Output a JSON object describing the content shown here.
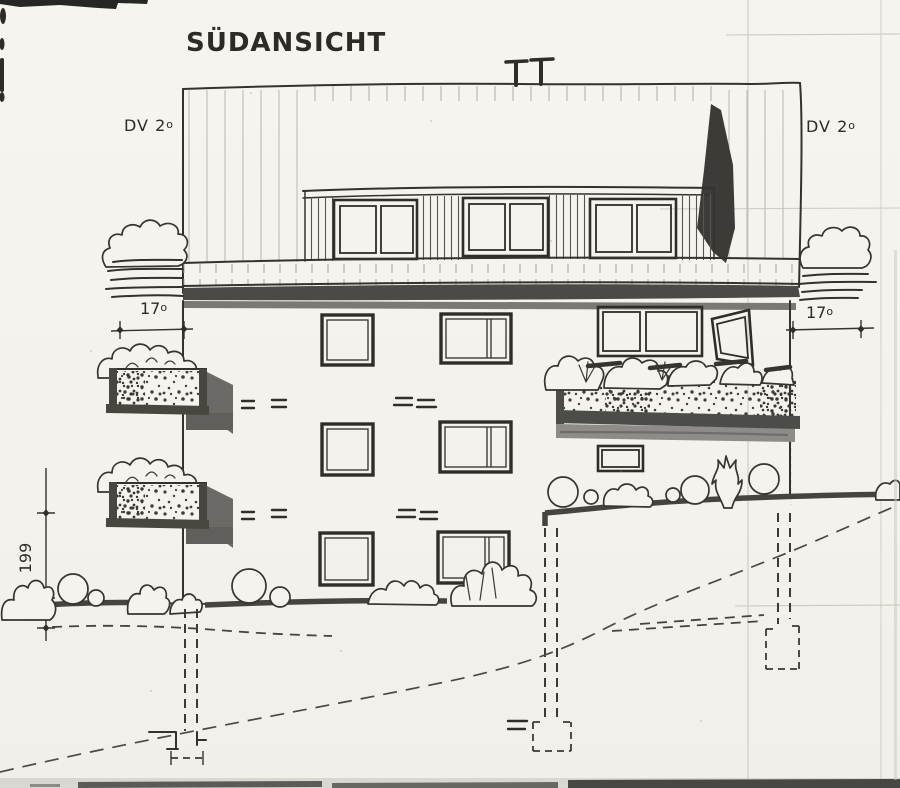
{
  "drawing": {
    "title": "SÜDANSICHT",
    "type": "hand-drawn architectural south elevation, scanned"
  },
  "labels": {
    "title": "SÜDANSICHT",
    "roof_left": {
      "text": "DV 2",
      "suffix": "o"
    },
    "roof_right": {
      "text": "DV 2",
      "suffix": "o"
    },
    "dim_balcony_left": {
      "value": "17",
      "suffix": "o"
    },
    "dim_balcony_right": {
      "value": "17",
      "suffix": "o"
    },
    "dim_height": "199",
    "dim_depth": {
      "value": "5",
      "suffix": "o"
    }
  },
  "colors": {
    "paper": "#f5f3ee",
    "ink": "#2e2d2a",
    "shade_dark": "#47463f",
    "shade_mid": "#7b7975",
    "shade_light": "#8e8c88",
    "pencil_guide": "#ccc9c2"
  }
}
